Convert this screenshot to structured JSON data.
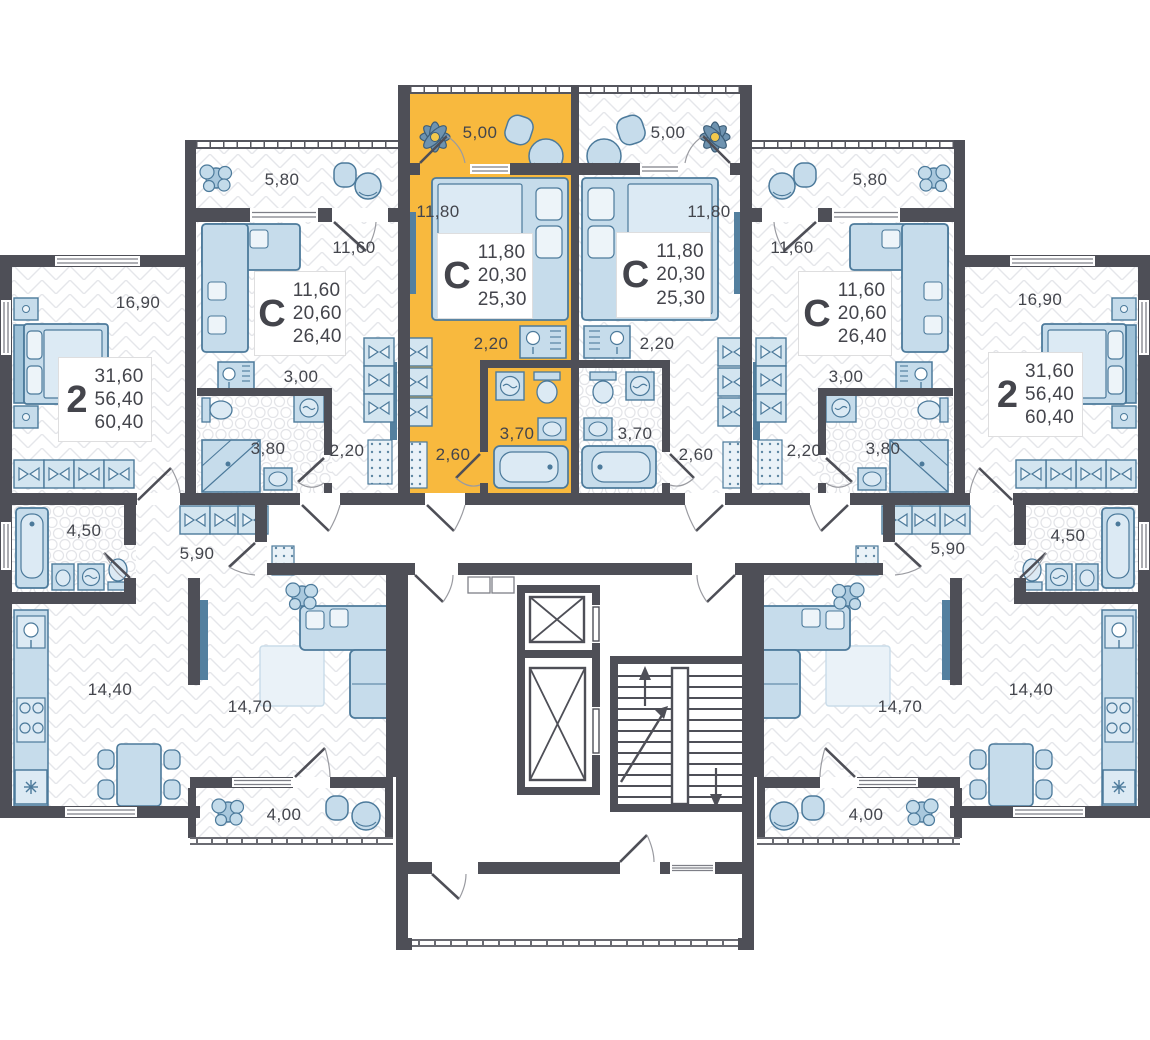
{
  "plan": {
    "kind": "residential-floor-plan",
    "colors": {
      "highlight": "#F8B93E",
      "wall": "#4E4F57",
      "furniture_fill": "#C6DCEB",
      "furniture_stroke": "#4C7A9B",
      "floor_line": "#E5E6EA",
      "label_text": "#43454C"
    }
  },
  "apartments": {
    "studio_left": {
      "type": "С",
      "highlighted": true,
      "areas": {
        "living": "11,80",
        "total": "20,30",
        "full": "25,30"
      },
      "rooms": {
        "balcony": "5,00",
        "living": "11,80",
        "hall": "2,20",
        "bath": "3,70",
        "entry": "2,60"
      }
    },
    "studio_right": {
      "type": "С",
      "highlighted": false,
      "areas": {
        "living": "11,80",
        "total": "20,30",
        "full": "25,30"
      },
      "rooms": {
        "balcony": "5,00",
        "living": "11,80",
        "hall": "2,20",
        "bath": "3,70",
        "entry": "2,60"
      }
    },
    "c_left": {
      "type": "С",
      "highlighted": false,
      "areas": {
        "living": "11,60",
        "total": "20,60",
        "full": "26,40"
      },
      "rooms": {
        "balcony": "5,80",
        "living": "11,60",
        "hall": "3,00",
        "bath": "3,80",
        "entry": "2,20"
      }
    },
    "c_right": {
      "type": "С",
      "highlighted": false,
      "areas": {
        "living": "11,60",
        "total": "20,60",
        "full": "26,40"
      },
      "rooms": {
        "balcony": "5,80",
        "living": "11,60",
        "hall": "3,00",
        "bath": "3,80",
        "entry": "2,20"
      }
    },
    "two_left": {
      "type": "2",
      "highlighted": false,
      "areas": {
        "living": "31,60",
        "total": "56,40",
        "full": "60,40"
      },
      "rooms": {
        "bedroom": "16,90",
        "bath": "4,50",
        "hall": "5,90",
        "kitchen": "14,40",
        "living": "14,70",
        "balcony": "4,00"
      }
    },
    "two_right": {
      "type": "2",
      "highlighted": false,
      "areas": {
        "living": "31,60",
        "total": "56,40",
        "full": "60,40"
      },
      "rooms": {
        "bedroom": "16,90",
        "bath": "4,50",
        "hall": "5,90",
        "kitchen": "14,40",
        "living": "14,70",
        "balcony": "4,00"
      }
    }
  }
}
